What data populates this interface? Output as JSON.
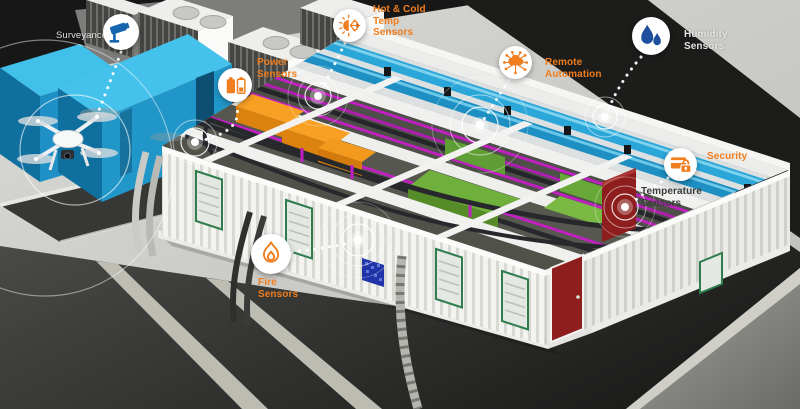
{
  "callouts": [
    {
      "id": "surveillance",
      "label": "Surveyance",
      "icon": "cctv-camera-icon",
      "label_color": "#F2F2F2"
    },
    {
      "id": "power-sensors",
      "label": "Power Sensors",
      "icon": "battery-icon",
      "label_color": "#F07D1E"
    },
    {
      "id": "hot-cold-temp-sensors",
      "label": "Hot & Cold Temp Sensors",
      "icon": "sun-snowflake-icon",
      "label_color": "#F07D1E"
    },
    {
      "id": "remote-automation",
      "label": "Remote Automation",
      "icon": "cloud-network-icon",
      "label_color": "#F07D1E"
    },
    {
      "id": "humidity-sensors",
      "label": "Humidity Sensors",
      "icon": "water-drops-icon",
      "label_color": "#E4E4E4"
    },
    {
      "id": "security",
      "label": "Security",
      "icon": "card-lock-icon",
      "label_color": "#F07D1E"
    },
    {
      "id": "temperature-sensors",
      "label": "Temperature Sensors",
      "icon": "sensor-node",
      "label_color": "#3B3B3B"
    },
    {
      "id": "fire-sensors",
      "label": "Fire Sensors",
      "icon": "flame-icon",
      "label_color": "#F07D1E"
    }
  ],
  "palette": {
    "accent_orange": "#F07D1E",
    "label_white": "#F2F2F2",
    "label_dark": "#3B3B3B",
    "cctv_blue": "#1565AF",
    "drop_blue": "#1D4F9E",
    "container_cyan": "#2BA7DB",
    "duct_cyan": "#28A5D8",
    "conduit_magenta": "#C21FC2",
    "equipment_green": "#6FB03C",
    "crate_orange": "#F59D1F",
    "door_red": "#8E1D1D",
    "ground_dark": "#242424",
    "concrete_light": "#C9C9C6"
  }
}
